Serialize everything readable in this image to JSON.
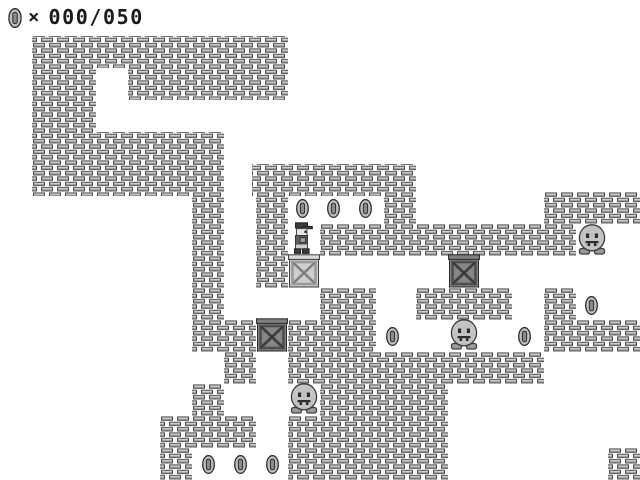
{
  "hud": {
    "coin_icon": "coin-icon",
    "separator": "×",
    "counter": "000/050"
  },
  "palette": {
    "background": "#ffffff",
    "brick_body": "#a6a6a6",
    "brick_highlight": "#dadada",
    "brick_outline": "#4d4d4d",
    "hud_text": "#1b1b1b"
  },
  "level": {
    "bricks": [
      [
        32,
        36,
        256,
        32
      ],
      [
        32,
        68,
        64,
        32
      ],
      [
        128,
        68,
        160,
        32
      ],
      [
        32,
        100,
        64,
        32
      ],
      [
        32,
        132,
        192,
        64
      ],
      [
        192,
        196,
        32,
        124
      ],
      [
        192,
        320,
        64,
        32
      ],
      [
        224,
        352,
        32,
        32
      ],
      [
        192,
        384,
        32,
        32
      ],
      [
        160,
        416,
        96,
        32
      ],
      [
        160,
        448,
        32,
        32
      ],
      [
        252,
        164,
        164,
        32
      ],
      [
        256,
        196,
        32,
        92
      ],
      [
        384,
        196,
        32,
        28
      ],
      [
        320,
        224,
        256,
        32
      ],
      [
        544,
        192,
        96,
        32
      ],
      [
        320,
        288,
        56,
        32
      ],
      [
        416,
        288,
        96,
        32
      ],
      [
        544,
        288,
        32,
        32
      ],
      [
        544,
        320,
        96,
        32
      ],
      [
        288,
        320,
        88,
        32
      ],
      [
        288,
        352,
        256,
        32
      ],
      [
        320,
        384,
        128,
        32
      ],
      [
        288,
        416,
        160,
        64
      ],
      [
        608,
        448,
        32,
        32
      ]
    ],
    "crates": [
      {
        "x": 288,
        "y": 254,
        "variant": "light"
      },
      {
        "x": 448,
        "y": 254,
        "variant": "dark"
      },
      {
        "x": 256,
        "y": 318,
        "variant": "dark"
      }
    ],
    "ghosts": [
      {
        "x": 576,
        "y": 223
      },
      {
        "x": 448,
        "y": 318
      },
      {
        "x": 288,
        "y": 382
      }
    ],
    "coins": [
      [
        296,
        199
      ],
      [
        327,
        199
      ],
      [
        359,
        199
      ],
      [
        386,
        327
      ],
      [
        518,
        327
      ],
      [
        585,
        296
      ],
      [
        202,
        455
      ],
      [
        234,
        455
      ],
      [
        266,
        455
      ]
    ],
    "player": {
      "x": 291,
      "y": 222
    }
  }
}
